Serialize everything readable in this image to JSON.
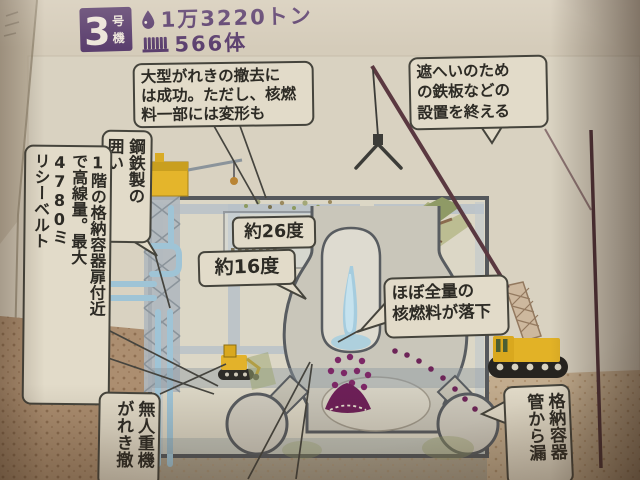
{
  "header": {
    "unit_number": "3",
    "unit_suffix": "号機",
    "water_amount": "1万3220トン",
    "fuel_count": "566体",
    "water_icon": "water-drop",
    "fuel_icon": "fuel-assembly"
  },
  "callouts": {
    "debris_removal": "大型がれきの撤去に\nは成功。ただし、核燃\n料一部には変形も",
    "shield_plates": "遮へいのため\nの鉄板などの\n設置を終える",
    "steel_enclosure": "鋼鉄製の\n囲い",
    "high_radiation": "1階の格納容器扉付近\nで高線量。最大\n4780ミ\nリシーベルト",
    "pool_temperature": "約26度",
    "well_temperature": "約16度",
    "fuel_fallen": "ほぼ全量の\n核燃料が落下",
    "unmanned_machine": "無人重機\nがれき撤",
    "containment_pipe_leak": "格納容器\n管から漏"
  },
  "colors": {
    "header_purple": "#5b3f6e",
    "paper": "#d5ccba",
    "callout_bg": "#e2dbc9",
    "callout_border": "#45443c",
    "fuel_debris": "#7c2766",
    "machine_yellow": "#e2b226",
    "pipe_blue": "#9fc4d6",
    "water_blue": "#a8cede",
    "ground_brown": "#ac8e70"
  }
}
